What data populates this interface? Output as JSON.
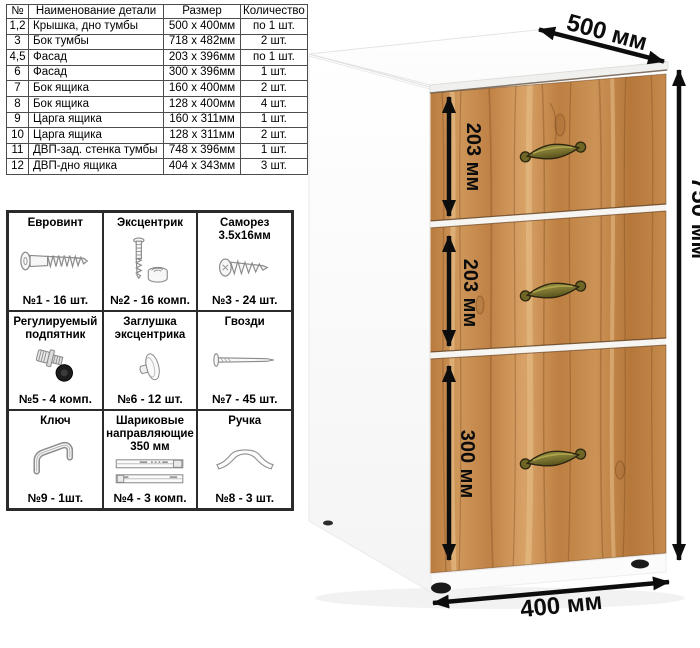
{
  "parts_table": {
    "headers": [
      "№",
      "Наименование детали",
      "Размер",
      "Количество"
    ],
    "rows": [
      [
        "1,2",
        "Крышка, дно тумбы",
        "500 х 400мм",
        "по 1 шт."
      ],
      [
        "3",
        "Бок тумбы",
        "718 х 482мм",
        "2 шт."
      ],
      [
        "4,5",
        "Фасад",
        "203 х 396мм",
        "по 1 шт."
      ],
      [
        "6",
        "Фасад",
        "300 х 396мм",
        "1 шт."
      ],
      [
        "7",
        "Бок ящика",
        "160 х 400мм",
        "2 шт."
      ],
      [
        "8",
        "Бок ящика",
        "128 х 400мм",
        "4 шт."
      ],
      [
        "9",
        "Царга ящика",
        "160 х 311мм",
        "1 шт."
      ],
      [
        "10",
        "Царга ящика",
        "128 х 311мм",
        "2 шт."
      ],
      [
        "11",
        "ДВП-зад. стенка тумбы",
        "748 х 396мм",
        "1 шт."
      ],
      [
        "12",
        "ДВП-дно ящика",
        "404 х 343мм",
        "3 шт."
      ]
    ]
  },
  "hardware": {
    "items": [
      {
        "title": "Евровинт",
        "icon": "euro-screw",
        "count": "№1 - 16 шт."
      },
      {
        "title": "Эксцентрик",
        "icon": "cam-lock",
        "count": "№2 - 16 комп."
      },
      {
        "title": "Саморез 3.5х16мм",
        "icon": "self-tapping-screw",
        "count": "№3 - 24 шт."
      },
      {
        "title": "Регулируемый подпятник",
        "icon": "adjustable-foot",
        "count": "№5 - 4 комп."
      },
      {
        "title": "Заглушка эксцентрика",
        "icon": "cam-cover",
        "count": "№6 - 12 шт."
      },
      {
        "title": "Гвозди",
        "icon": "nail",
        "count": "№7 - 45 шт."
      },
      {
        "title": "Ключ",
        "icon": "hex-key",
        "count": "№9 - 1шт."
      },
      {
        "title": "Шариковые направляющие 350 мм",
        "icon": "ball-slides",
        "count": "№4 - 3 комп."
      },
      {
        "title": "Ручка",
        "icon": "bow-handle",
        "count": "№8 - 3 шт."
      }
    ]
  },
  "cabinet": {
    "dimensions": {
      "depth": "500 мм",
      "height": "750 мм",
      "width": "400 мм",
      "drawer1_height": "203 мм",
      "drawer2_height": "203 мм",
      "drawer3_height": "300 мм"
    },
    "colors": {
      "wood": "#c68a4c",
      "body": "#ffffff",
      "handle": "#7b7431",
      "dimension_lines": "#0d0d0d"
    }
  }
}
